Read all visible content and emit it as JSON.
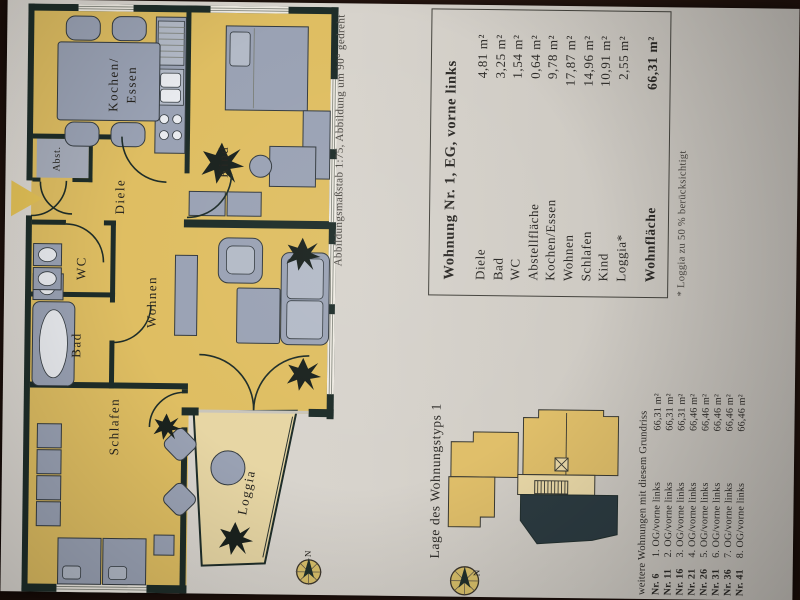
{
  "caption": "Abbildungsmaßstab 1:75, Abbildung um 90° gedreht",
  "plan": {
    "rooms": {
      "kochen_line1": "Kochen/",
      "kochen_line2": "Essen",
      "kind": "Kind",
      "diele": "Diele",
      "abst": "Abst.",
      "wc": "WC",
      "bad": "Bad",
      "wohnen": "Wohnen",
      "schlafen": "Schlafen",
      "loggia": "Loggia"
    },
    "compass_label": "N",
    "colors": {
      "room_fill": "#dfbe62",
      "loggia_fill": "#e7d6a4",
      "wall": "#1e2d29",
      "furniture": "#9aa2b4",
      "highlight_unit": "#2c3b41"
    }
  },
  "table": {
    "title": "Wohnung Nr. 1, EG, vorne links",
    "rows": [
      {
        "label": "Diele",
        "value": "4,81 m²"
      },
      {
        "label": "Bad",
        "value": "3,25 m²"
      },
      {
        "label": "WC",
        "value": "1,54 m²"
      },
      {
        "label": "Abstellfläche",
        "value": "0,64 m²"
      },
      {
        "label": "Kochen/Essen",
        "value": "9,78 m²"
      },
      {
        "label": "Wohnen",
        "value": "17,87 m²"
      },
      {
        "label": "Schlafen",
        "value": "14,96 m²"
      },
      {
        "label": "Kind",
        "value": "10,91 m²"
      },
      {
        "label": "Loggia*",
        "value": "2,55 m²"
      }
    ],
    "total": {
      "label": "Wohnfläche",
      "value": "66,31 m²"
    },
    "footnote": "* Loggia zu 50 % berücksichtigt"
  },
  "lage": {
    "heading": "Lage des Wohnungstyps 1",
    "list_title": "weitere Wohnungen mit diesem Grundriss",
    "compass_label": "N",
    "entries": [
      {
        "nr": "Nr. 6",
        "floor": "1. OG/vorne links",
        "area": "66,31 m²"
      },
      {
        "nr": "Nr. 11",
        "floor": "2. OG/vorne links",
        "area": "66,31 m²"
      },
      {
        "nr": "Nr. 16",
        "floor": "3. OG/vorne links",
        "area": "66,31 m²"
      },
      {
        "nr": "Nr. 21",
        "floor": "4. OG/vorne links",
        "area": "66,46 m²"
      },
      {
        "nr": "Nr. 26",
        "floor": "5. OG/vorne links",
        "area": "66,46 m²"
      },
      {
        "nr": "Nr. 31",
        "floor": "6. OG/vorne links",
        "area": "66,46 m²"
      },
      {
        "nr": "Nr. 36",
        "floor": "7. OG/vorne links",
        "area": "66,46 m²"
      },
      {
        "nr": "Nr. 41",
        "floor": "8. OG/vorne links",
        "area": "66,46 m²"
      }
    ]
  }
}
